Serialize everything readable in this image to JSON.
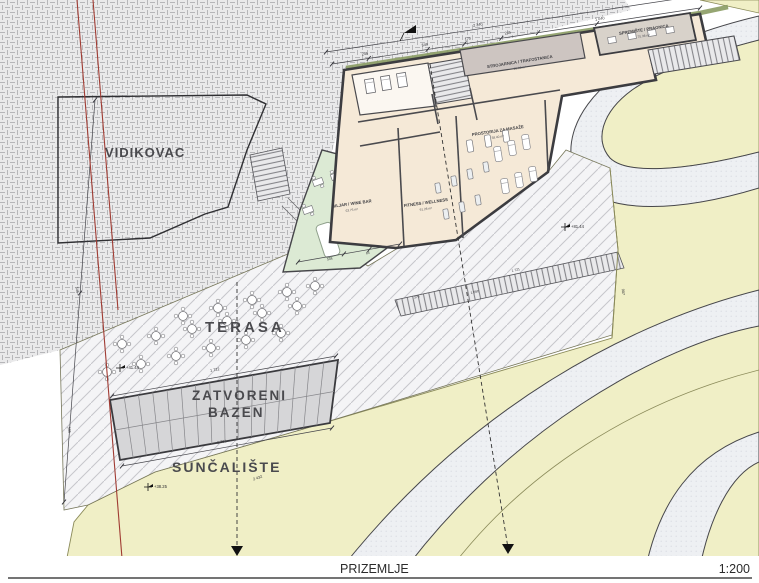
{
  "sheet": {
    "floor_label": "PRIZEMLJE",
    "scale_label": "1:200"
  },
  "site_labels": {
    "vidikovac": "VIDIKOVAC",
    "terasa": "TERASA",
    "zatvoreni_line1": "ZATVORENI",
    "zatvoreni_line2": "BAZEN",
    "suncaliste": "SUNČALIŠTE"
  },
  "rooms": {
    "strojarnica": {
      "name": "STROJARNICA / TRAFOSTANICA",
      "area": "95.86 m²"
    },
    "spremiste": {
      "name": "SPREMIŠTE / PRAONICA",
      "area": "75.38 m²"
    },
    "masaza": {
      "name": "PROSTORIJA ZA MASAŽE",
      "area": "38.40 m²"
    },
    "fitness": {
      "name": "FITNESS / WELLNESS",
      "area": "91.28 m²"
    },
    "biljar": {
      "name": "BILJAR / WINE BAR",
      "area": "63.75 m²"
    }
  },
  "dimensions": {
    "total_top": "2 340",
    "t1": "245",
    "t2": "549",
    "t3": "170",
    "t4": "245",
    "t5": "1 040",
    "pool_top": "1 722",
    "pool_bottom": "1 761",
    "site_boundary": "2 432",
    "slope_right": "907",
    "left_upper": "545",
    "left_lower": "585",
    "walk_upper": "1 660",
    "walk_lower": "1 721",
    "walk_short": "376",
    "green_a": "504",
    "green_b": "85"
  },
  "spot_elevations": {
    "e1": "+41.44",
    "e2": "+38.25",
    "e3": "+81.44"
  },
  "colors": {
    "terrain_yellow": "#f0efc6",
    "hatch_gray": "#e9e9ea",
    "road_gray": "#eef0f3",
    "pool_gray": "#d6d6d8",
    "floor_beige": "#f5e9d7",
    "floor_green": "#dcead4",
    "plant_green": "#8a9b63",
    "wall_dark": "#3c3c40",
    "boundary_red": "#a03b33"
  }
}
